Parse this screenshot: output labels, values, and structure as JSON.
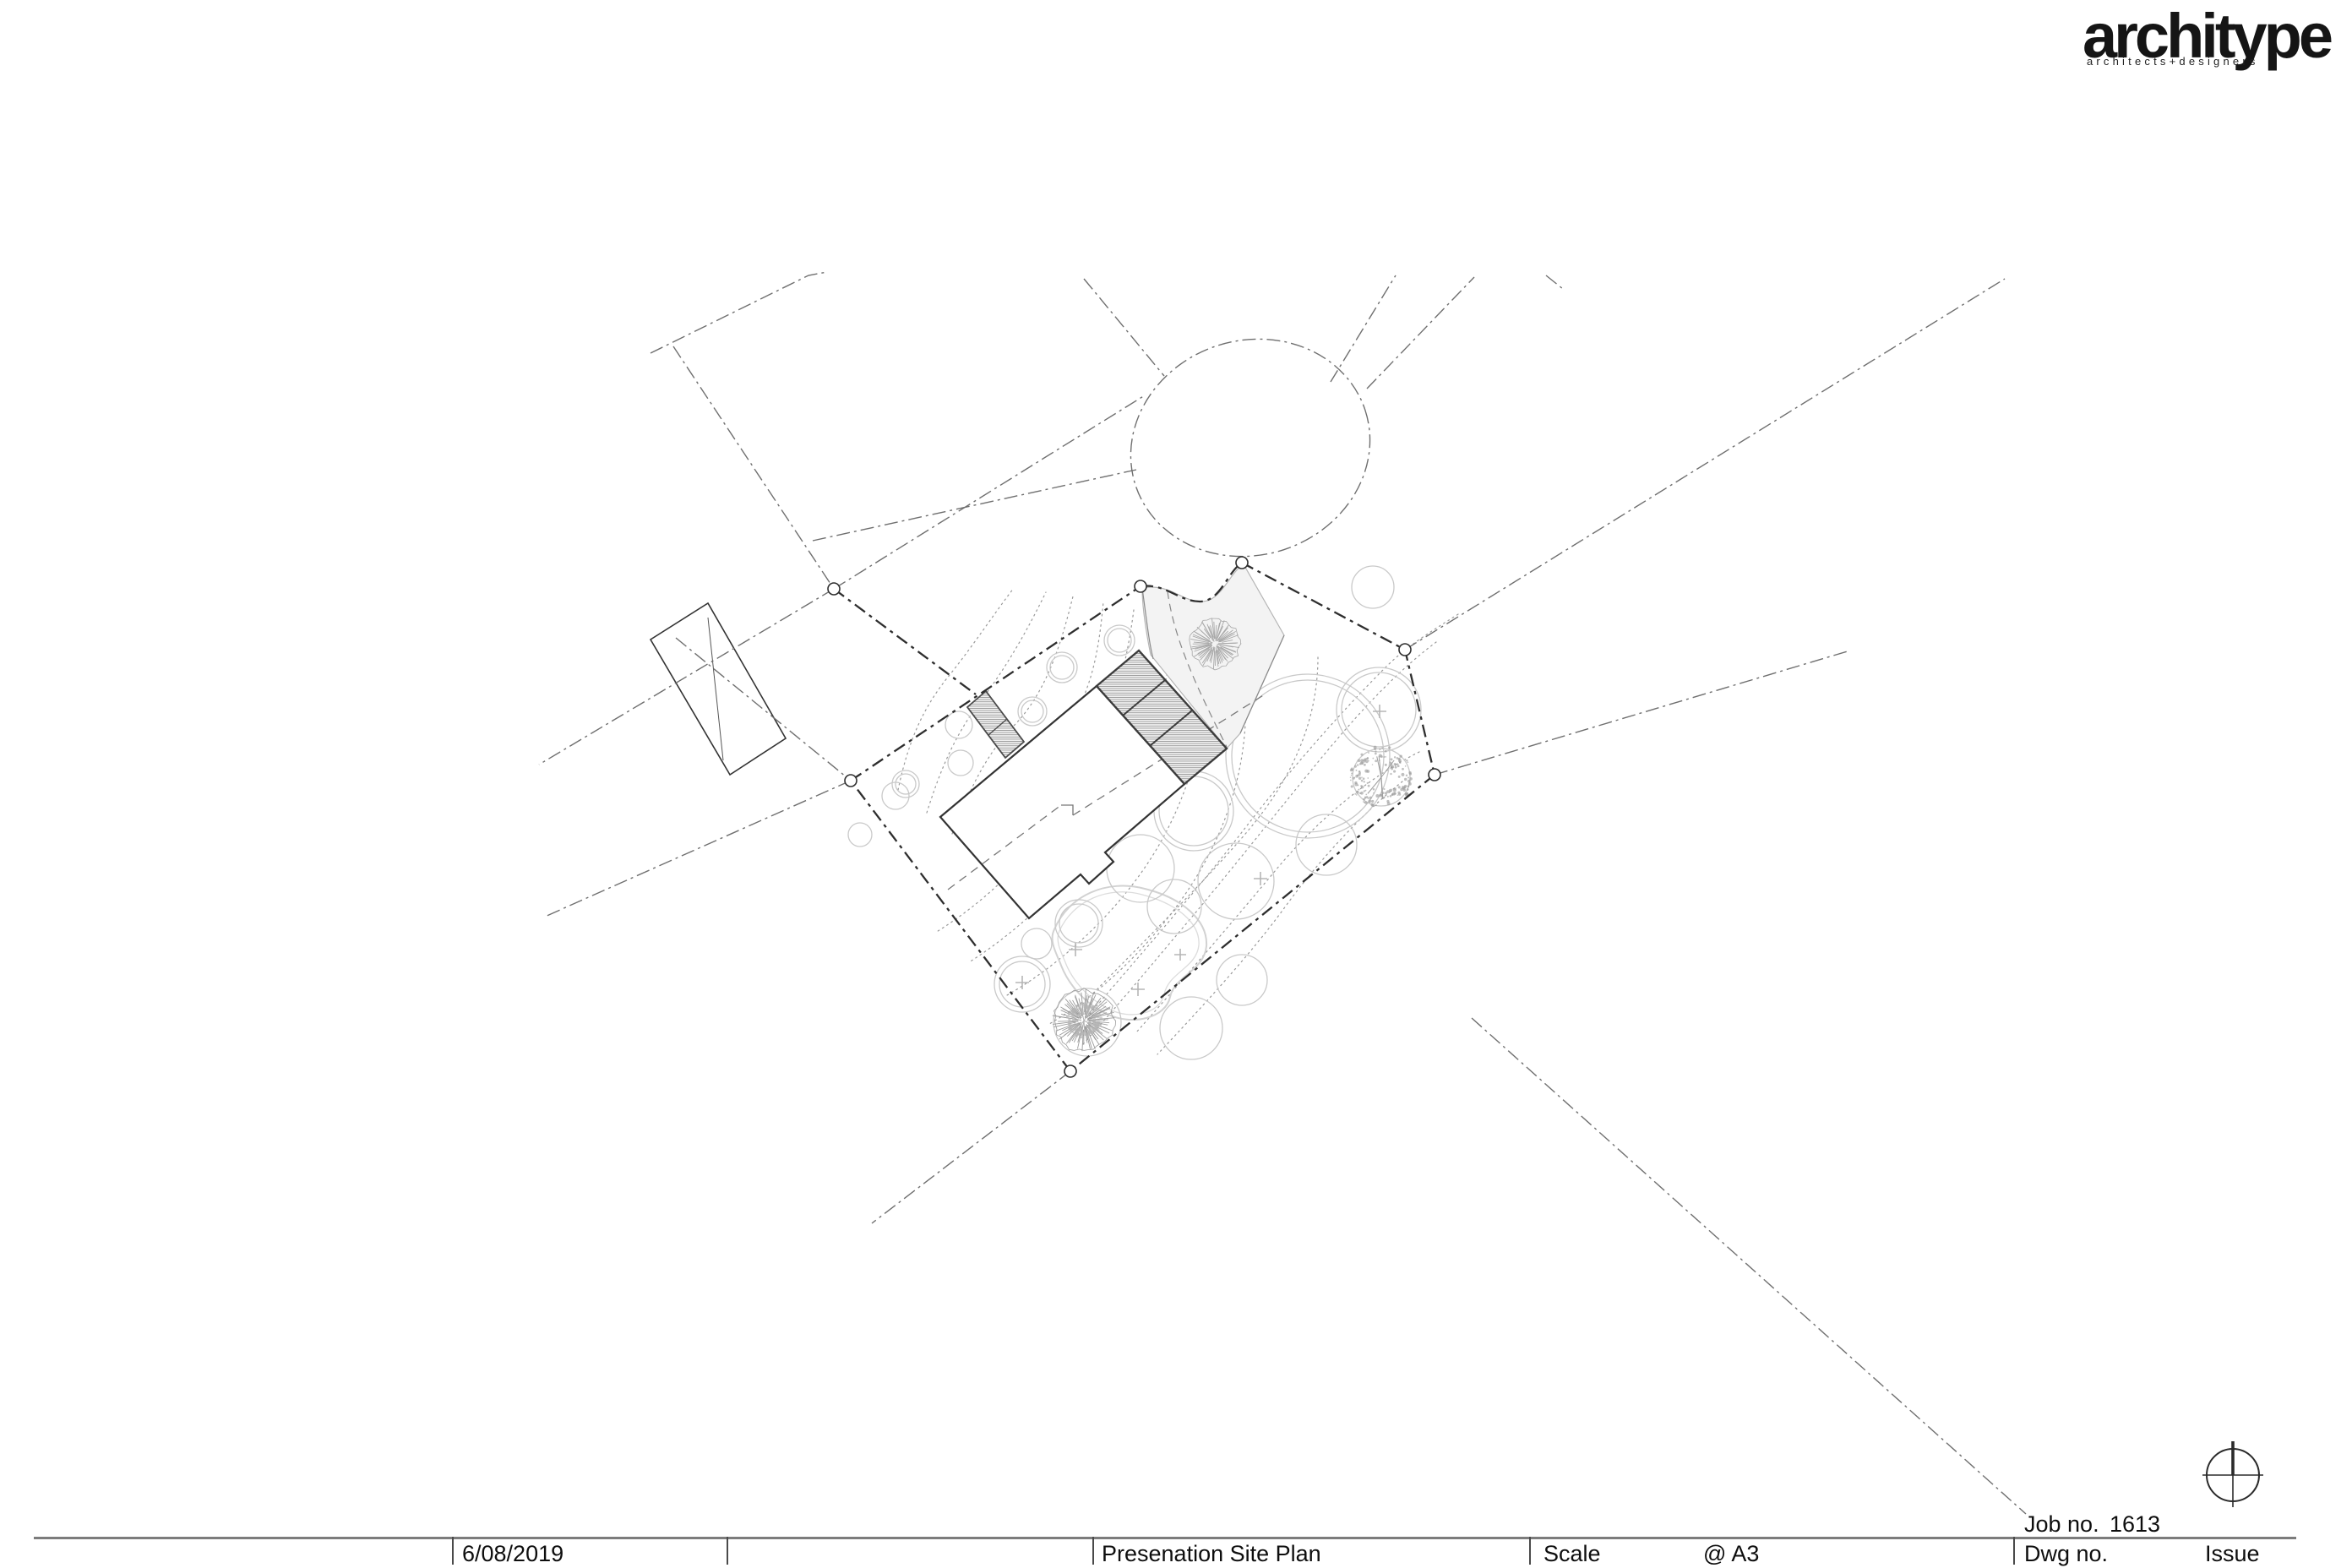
{
  "page": {
    "background": "#ffffff",
    "kind": "architectural presentation site plan sheet"
  },
  "logo": {
    "brand": "architype",
    "tagline": "architects+designers",
    "color": "#151515"
  },
  "title_block": {
    "date": "6/08/2019",
    "drawing_title": "Presenation Site Plan",
    "scale_label": "Scale",
    "scale_value": "@ A3",
    "job_label": "Job no.",
    "job_number": "1613",
    "dwg_label": "Dwg no.",
    "issue_label": "Issue"
  },
  "drawing": {
    "symbols": [
      "north-symbol-icon",
      "site-boundary",
      "boundary-corner-markers",
      "cul-de-sac",
      "road-centerlines",
      "building-footprint",
      "hatched-deck-panels",
      "driveway-area",
      "contour-lines",
      "tree-canopies",
      "detailed-trees",
      "survey-plus-marks"
    ],
    "colors": {
      "boundary": "#2e2e2e",
      "roads": "#6f6f6f",
      "contours": "#9a9a9a",
      "vegetation": "#c9c9c9",
      "building_outline": "#333333",
      "drive_fill": "#f3f3f3",
      "rule": "#7c7c7c"
    }
  }
}
